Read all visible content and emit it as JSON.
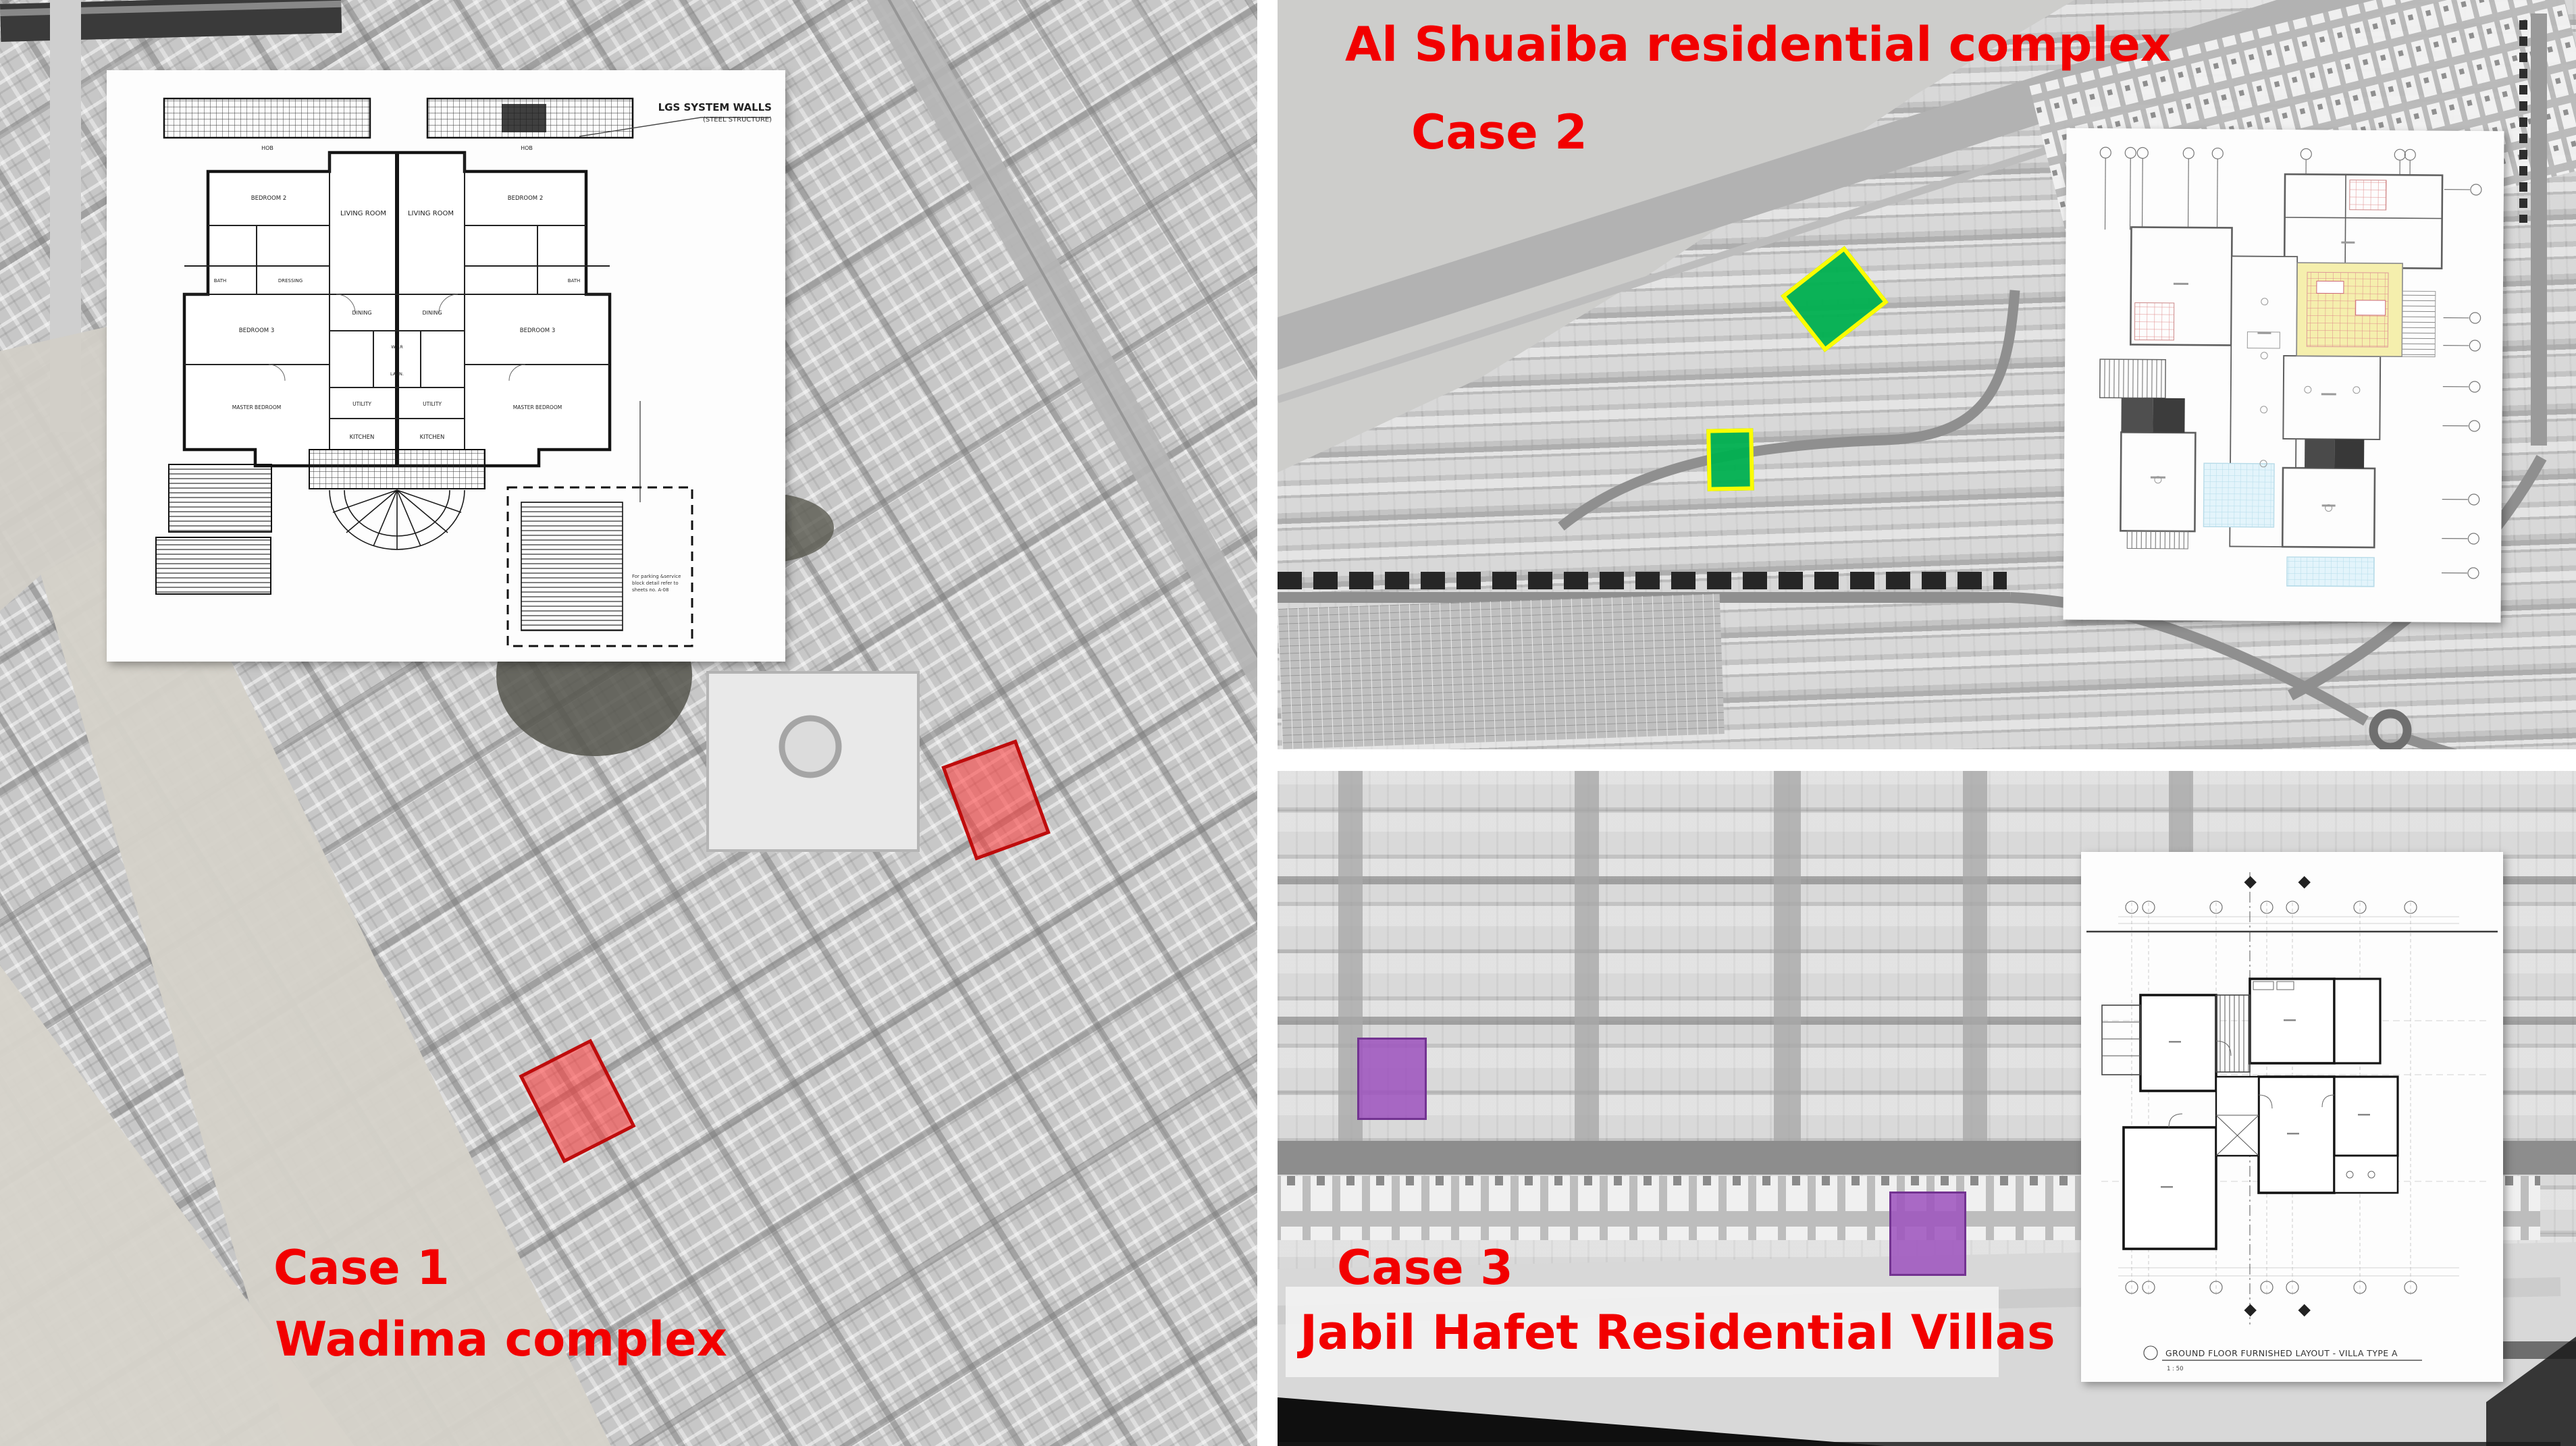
{
  "case1": {
    "case_label": "Case 1",
    "name_label": "Wadima complex",
    "plan": {
      "callout_line1": "LGS SYSTEM WALLS",
      "callout_line2": "(STEEL STRUCTURE)",
      "rooms": {
        "hob_left": "HOB",
        "hob_right": "HOB",
        "living_left": "LIVING ROOM",
        "living_right": "LIVING ROOM",
        "bedroom2_left": "BEDROOM 2",
        "bedroom2_right": "BEDROOM 2",
        "bath_left": "BATH",
        "bath_right": "BATH",
        "dressing": "DRESSING",
        "bedroom3_left": "BEDROOM 3",
        "bedroom3_right": "BEDROOM 3",
        "master_left": "MASTER BEDROOM",
        "master_right": "MASTER BEDROOM",
        "dining_left": "DINING",
        "dining_right": "DINING",
        "wtr": "W.T.R",
        "laundry": "LAUN.",
        "utility_left": "UTILITY",
        "utility_right": "UTILITY",
        "kitchen_left": "KITCHEN",
        "kitchen_right": "KITCHEN"
      },
      "note_line1": "For parking &service",
      "note_line2": "block detail refer to",
      "note_line3": "sheets no. A-08"
    }
  },
  "case2": {
    "name_label": "Al Shuaiba residential complex",
    "case_label": "Case 2"
  },
  "case3": {
    "case_label": "Case 3",
    "name_label": "Jabil Hafet Residential Villas",
    "plan_caption": "GROUND FLOOR FURNISHED LAYOUT - VILLA TYPE A",
    "plan_scale": "1 : 50"
  },
  "annotation_colors": {
    "label_red": "#f20000",
    "case1_fill": "#ff3737",
    "case1_border": "#b90000",
    "case2_fill": "#00b050",
    "case2_border": "#fcfc00",
    "case3_fill": "#9e55be",
    "case3_border": "#70308e"
  }
}
